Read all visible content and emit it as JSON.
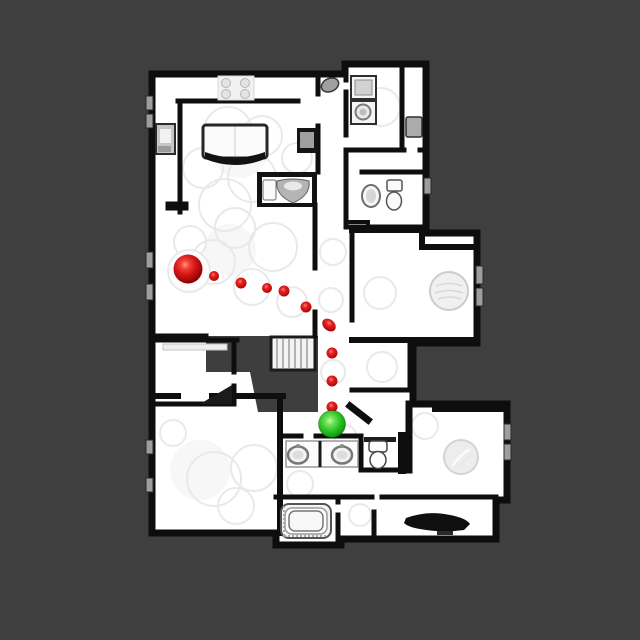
{
  "scene": {
    "type": "floorplan-navigation-topdown",
    "background_color": "#3f3f3f",
    "floor_color": "#ffffff",
    "wall_color": "#0d0d0d",
    "stairwell_color": "#3e3e3e"
  },
  "navigation": {
    "start_marker": {
      "label": "start-point",
      "color": "#d51515",
      "x": 188,
      "y": 269,
      "radius": 14.5
    },
    "goal_marker": {
      "label": "goal-point",
      "color": "#2cc228",
      "x": 332,
      "y": 424,
      "radius": 13.5
    },
    "waypoint_color": "#d51515",
    "waypoints": [
      {
        "x": 214,
        "y": 276,
        "r": 5
      },
      {
        "x": 241,
        "y": 283,
        "r": 5.5
      },
      {
        "x": 267,
        "y": 288,
        "r": 5
      },
      {
        "x": 284,
        "y": 291,
        "r": 5.5
      },
      {
        "x": 306,
        "y": 307,
        "r": 5.5
      },
      {
        "x": 329,
        "y": 325,
        "r": 5.5,
        "rx": 7.5,
        "tilt": 40
      },
      {
        "x": 332,
        "y": 353,
        "r": 5.5
      },
      {
        "x": 332,
        "y": 381,
        "r": 5.5
      },
      {
        "x": 332,
        "y": 407,
        "r": 5.5
      }
    ]
  }
}
